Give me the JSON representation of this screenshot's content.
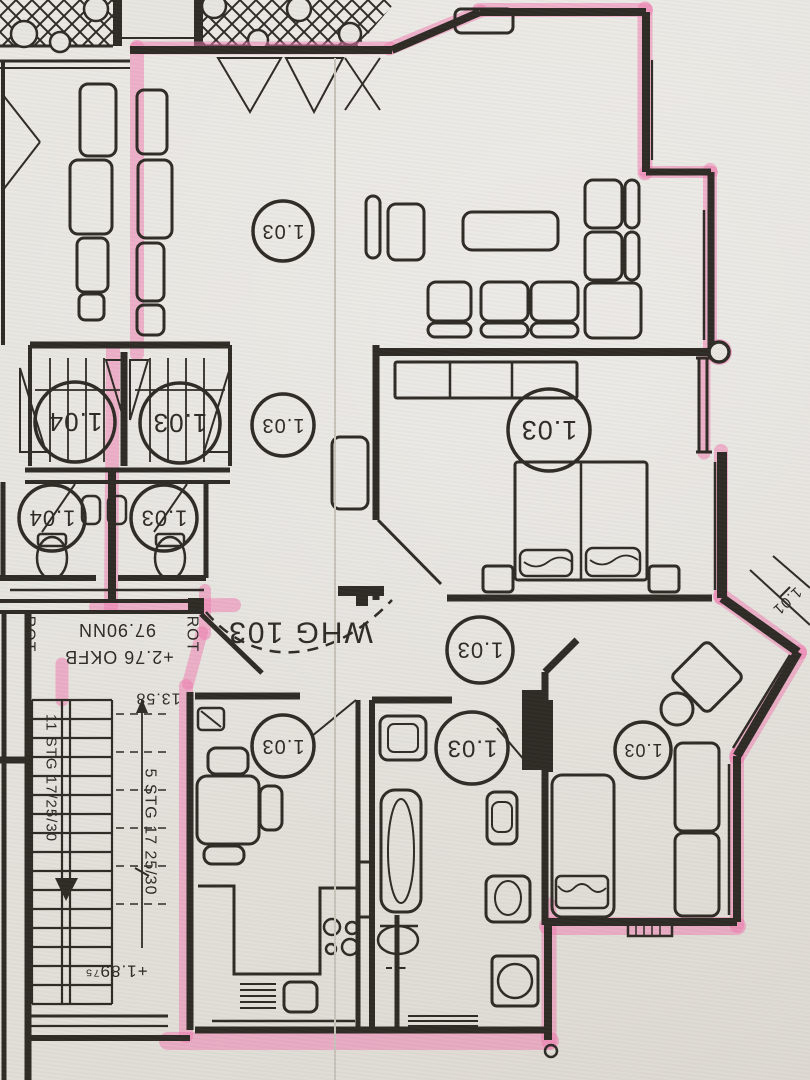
{
  "colors": {
    "paper": "#e7e5e0",
    "paper_shade": "#dcd9d3",
    "ink": "#2b2722",
    "highlighter": "#ef77ad",
    "crease": "#c6c2b9"
  },
  "floorplan": {
    "apartment_label": "WHG 103",
    "room_labels": [
      {
        "text": "1.03",
        "x": 283,
        "y": 231,
        "r": 30
      },
      {
        "text": "1.04",
        "x": 75,
        "y": 422,
        "r": 40
      },
      {
        "text": "1.03",
        "x": 180,
        "y": 423,
        "r": 40
      },
      {
        "text": "1.03",
        "x": 283,
        "y": 425,
        "r": 31
      },
      {
        "text": "1.03",
        "x": 549,
        "y": 430,
        "r": 41
      },
      {
        "text": "1.04",
        "x": 52,
        "y": 518,
        "r": 33
      },
      {
        "text": "1.03",
        "x": 164,
        "y": 518,
        "r": 33
      },
      {
        "text": "1.03",
        "x": 480,
        "y": 650,
        "r": 33
      },
      {
        "text": "1.03",
        "x": 283,
        "y": 746,
        "r": 31
      },
      {
        "text": "1.03",
        "x": 472,
        "y": 748,
        "r": 36
      },
      {
        "text": "1.03",
        "x": 643,
        "y": 750,
        "r": 28
      }
    ],
    "annotations": [
      {
        "id": "apartment-number",
        "text": "WHG 103",
        "x": 300,
        "y": 632,
        "angle": 180,
        "size": 30,
        "ls": 2
      },
      {
        "id": "rot-left",
        "text": "ROT",
        "x": 29,
        "y": 634,
        "angle": 90,
        "size": 16,
        "ls": 1
      },
      {
        "id": "rot-right",
        "text": "ROT",
        "x": 192,
        "y": 634,
        "angle": 90,
        "size": 16,
        "ls": 1
      },
      {
        "id": "level-97-90",
        "text": "97.90NN",
        "x": 117,
        "y": 630,
        "angle": 180,
        "size": 18,
        "ls": 1
      },
      {
        "id": "level-2-76",
        "text": "+2.76 OKFB",
        "x": 119,
        "y": 657,
        "angle": 180,
        "size": 18,
        "ls": 1
      },
      {
        "id": "dim-13-58",
        "text": "13.58",
        "x": 158,
        "y": 698,
        "angle": 180,
        "size": 16,
        "ls": 1
      },
      {
        "id": "stairs-11",
        "text": "11 STG 17/25/30",
        "x": 51,
        "y": 778,
        "angle": 90,
        "size": 15,
        "ls": 1
      },
      {
        "id": "stairs-5",
        "text": "5 STG 17 25/30",
        "x": 150,
        "y": 832,
        "angle": 90,
        "size": 16,
        "ls": 1
      },
      {
        "id": "level-1-89",
        "text": "+1.89⁷⁵",
        "x": 116,
        "y": 971,
        "angle": 180,
        "size": 17,
        "ls": 1
      },
      {
        "id": "dim-1-01",
        "text": "1.01",
        "x": 787,
        "y": 601,
        "angle": 137,
        "size": 15,
        "ls": 1
      }
    ]
  }
}
